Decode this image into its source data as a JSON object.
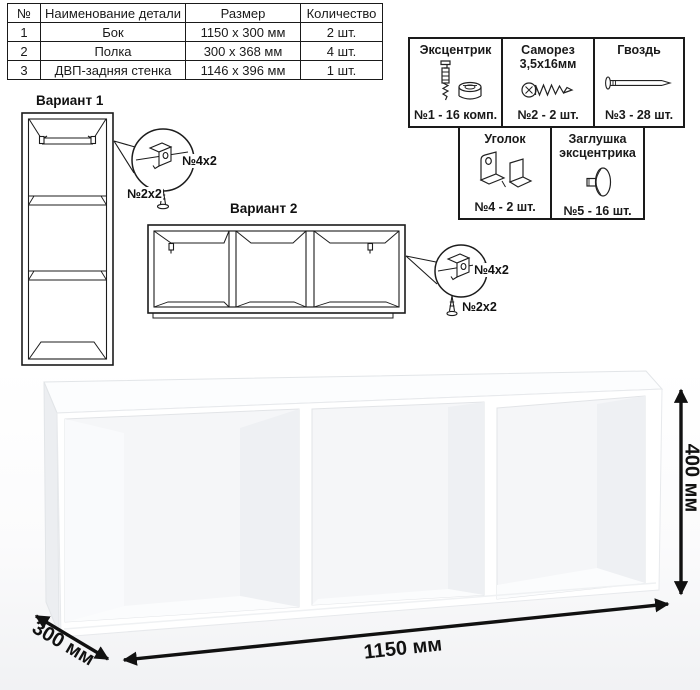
{
  "parts_table": {
    "headers": [
      "№",
      "Наименование детали",
      "Размер",
      "Количество"
    ],
    "rows": [
      {
        "num": "1",
        "name": "Бок",
        "size": "1150 х 300 мм",
        "qty": "2 шт."
      },
      {
        "num": "2",
        "name": "Полка",
        "size": "300 х 368 мм",
        "qty": "4 шт."
      },
      {
        "num": "3",
        "name": "ДВП-задняя стенка",
        "size": "1146 х 396 мм",
        "qty": "1 шт."
      }
    ]
  },
  "hardware": {
    "items": [
      {
        "title": "Эксцентрик",
        "count": "№1 - 16 комп."
      },
      {
        "title": "Саморез 3,5х16мм",
        "count": "№2 - 2 шт."
      },
      {
        "title": "Гвоздь",
        "count": "№3 - 28 шт."
      },
      {
        "title": "Уголок",
        "count": "№4 - 2 шт."
      },
      {
        "title": "Заглушка эксцентрика",
        "count": "№5 - 16 шт."
      }
    ]
  },
  "variants": {
    "variant1": {
      "title": "Вариант 1",
      "bracket_label": "№4х2",
      "screw_label": "№2х2"
    },
    "variant2": {
      "title": "Вариант 2",
      "bracket_label": "№4х2",
      "screw_label": "№2х2"
    }
  },
  "dimensions": {
    "width": "1150 мм",
    "depth": "300 мм",
    "height": "400 мм"
  },
  "colors": {
    "line": "#1c1c1c",
    "dimension": "#111111",
    "shelf_edge": "#e2e5e8"
  }
}
